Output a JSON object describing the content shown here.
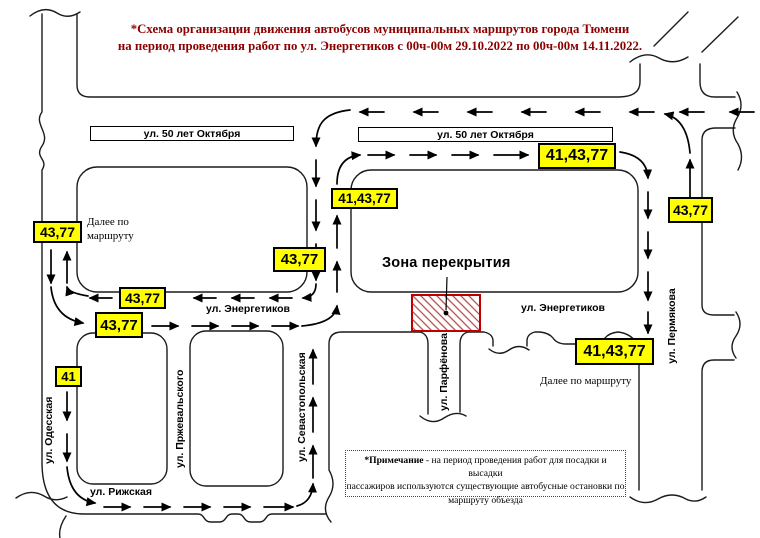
{
  "title": {
    "line1": "*Схема организации движения автобусов муниципальных маршрутов города Тюмени",
    "line2": "на период проведения  работ по ул. Энергетиков с 00ч-00м 29.10.2022 по 00ч-00м 14.11.2022."
  },
  "colors": {
    "title_text": "#8B0000",
    "badge_fill": "#FFFF00",
    "badge_border": "#000000",
    "closure_border": "#C00000",
    "closure_hatch": "#C05050",
    "road_line": "#1b1b1b"
  },
  "street_signs": {
    "oktyabrya_left": "ул. 50 лет Октября",
    "oktyabrya_right": "ул. 50 лет Октября"
  },
  "streets": {
    "energetikov_left": "ул. Энергетиков",
    "energetikov_right": "ул. Энергетиков",
    "odesskaya": "ул. Одесская",
    "przhevalskogo": "ул. Пржевальского",
    "sevastopolskaya": "ул. Севастопольская",
    "parfyonova": "ул. Парфёнова",
    "permyakova": "ул. Пермякова",
    "rizhskaya": "ул. Рижская"
  },
  "badges": {
    "odesskaya_north": "43,77",
    "mid_street_south": "43,77",
    "energetikov_westbound": "43,77",
    "energetikov_eastbound": "43,77",
    "odesskaya_41": "41",
    "sevastopolskaya_north": "41,43,77",
    "oktyabrya_east": "41,43,77",
    "permyakova_south": "41,43,77",
    "permyakova_north": "43,77"
  },
  "closure": {
    "label": "Зона перекрытия"
  },
  "route_continuation": {
    "left_line1": "Далее по",
    "left_line2": "маршруту",
    "right": "Далее по маршруту"
  },
  "note": {
    "bold": "*Примечание",
    "line1_rest": " - на период проведения  работ для посадки и высадки",
    "line2": "пассажиров используются существующие автобусные остановки по",
    "line3": "маршруту объезда"
  }
}
